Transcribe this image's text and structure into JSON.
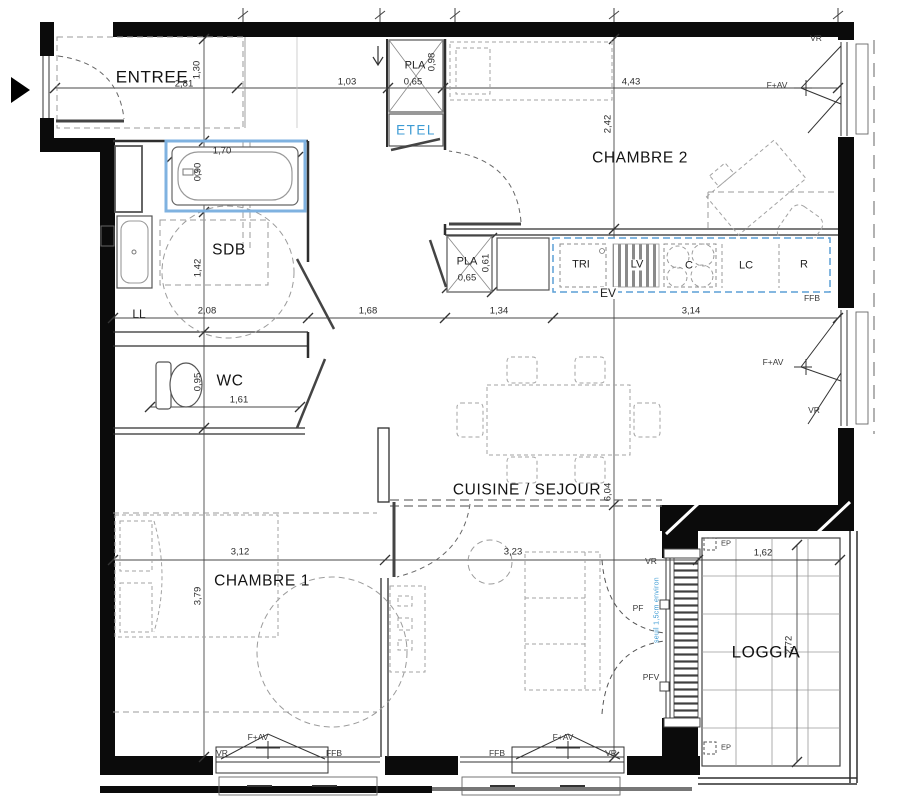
{
  "plan": {
    "rooms": {
      "entree": "ENTREE",
      "chambre2": "CHAMBRE 2",
      "sdb": "SDB",
      "wc": "WC",
      "cuisine_sejour": "CUISINE / SEJOUR",
      "chambre1": "CHAMBRE 1",
      "loggia": "LOGGIA"
    },
    "closets": {
      "etel": "ETEL",
      "pla": "PLA"
    },
    "kitchen_units": {
      "tri": "TRI",
      "lv": "LV",
      "c": "C",
      "lc": "LC",
      "r": "R",
      "ev": "EV",
      "ll": "LL"
    },
    "window_labels": {
      "vr": "VR",
      "fav": "F+AV",
      "ffb": "FFB",
      "pf": "PF",
      "pfv": "PFV",
      "ep": "EP"
    },
    "annotations": {
      "seuil": "seuil 1,5cm environ"
    },
    "dimensions": {
      "d281": "2,81",
      "d130": "1,30",
      "d103": "1,03",
      "d065": "0,65",
      "d098": "0,98",
      "d443": "4,43",
      "d242": "2,42",
      "d170": "1,70",
      "d090": "0,90",
      "d142": "1,42",
      "d208": "2,08",
      "d168": "1,68",
      "d134": "1,34",
      "d314": "3,14",
      "d061": "0,61",
      "d161": "1,61",
      "d095": "0,95",
      "d312": "3,12",
      "d323": "3,23",
      "d379": "3,79",
      "d604": "6,04",
      "d162": "1,62",
      "d272": "2,72"
    },
    "colors": {
      "wall": "#0b0b0b",
      "line": "#3a3a3a",
      "accent_blue": "#3d9bd4",
      "counter_blue": "#5b9fd6"
    }
  }
}
